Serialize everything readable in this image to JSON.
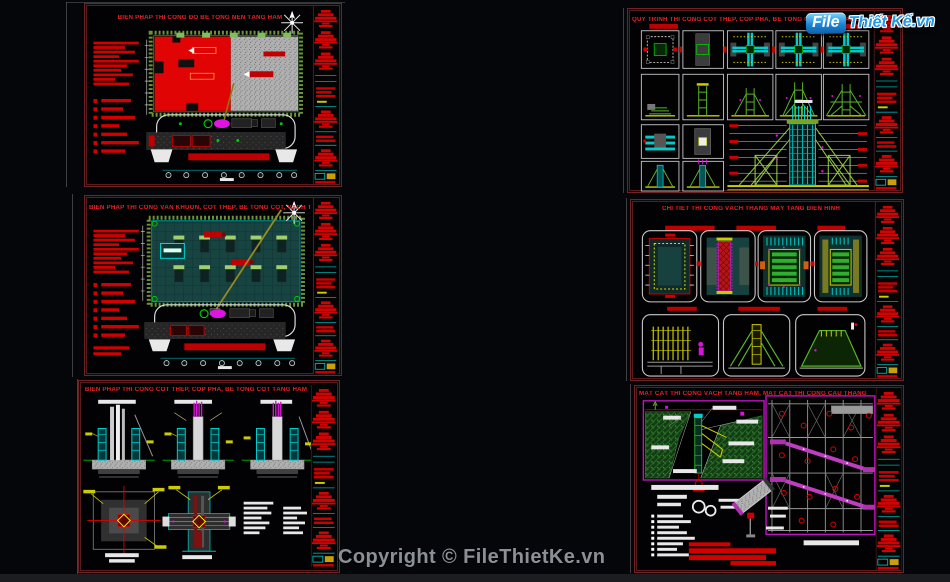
{
  "page": {
    "background": "#05060a",
    "bottom_bar_color": "#1c1d20"
  },
  "watermark": {
    "logo": {
      "badge": "File",
      "text": "Thiết Kế.vn",
      "badge_bg": "#1b86d8",
      "text_color": "#1f9ae8",
      "outline_color": "#ffffff"
    },
    "copyright": "Copyright © FileThietKe.vn",
    "copyright_color": "#8b9097"
  },
  "colors": {
    "sheet_border": "#6e2424",
    "title_red": "#e62222",
    "annotation_red": "#d40000",
    "cad_cyan": "#00cccc",
    "cad_teal_fill": "#17413e",
    "cad_green": "#3fae3f",
    "hatch_green": "#7fae3f",
    "cad_magenta": "#d616d6",
    "cad_yellow": "#d4c400",
    "concrete_gray": "#b0b0b0",
    "white_lines": "#e8e8e8",
    "panel_border_magenta": "#c014c0"
  },
  "sheets": [
    {
      "id": "sheet-1",
      "title": "BIỆN PHÁP THI CÔNG ĐỔ BÊ TÔNG NỀN TẦNG HẦM"
    },
    {
      "id": "sheet-2",
      "title": "BIỆN PHÁP THI CÔNG VÁN KHUÔN, CỐT THÉP, BÊ TÔNG CỘT, VÁCH TẦNG HẦM"
    },
    {
      "id": "sheet-3",
      "title": "BIỆN PHÁP THI CÔNG CỐT THÉP, CỐP PHA, BÊ TÔNG CỘT TẦNG HẦM"
    },
    {
      "id": "sheet-4",
      "title": "QUY TRÌNH THI CÔNG CỐT THÉP, CỐP PHA, BÊ TÔNG CỘT, VÁCH TẦNG HẦM"
    },
    {
      "id": "sheet-5",
      "title": "CHI TIẾT THI CÔNG VÁCH THANG MÁY TẦNG ĐIỂN HÌNH"
    },
    {
      "id": "sheet-6",
      "title": "MẶT CẮT THI CÔNG VÁCH TẦNG HẦM, MẶT CẮT THI CÔNG CẦU THANG BỘ"
    }
  ]
}
